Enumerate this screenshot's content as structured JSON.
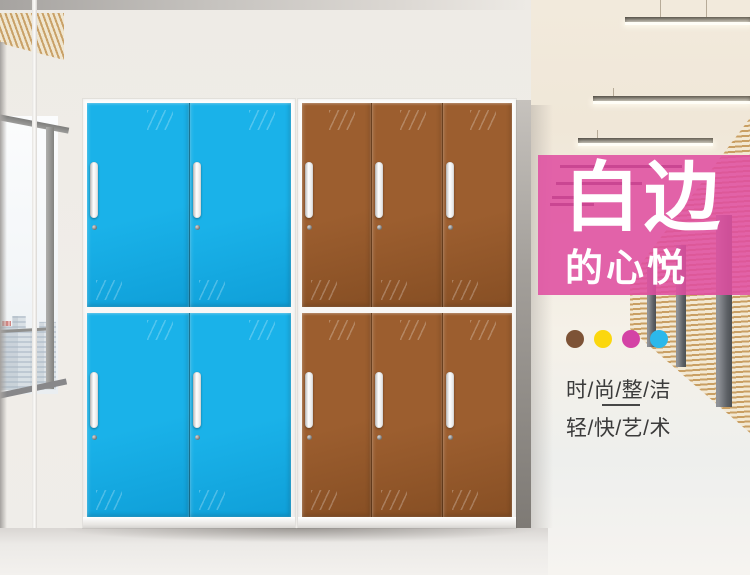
{
  "banner": {
    "title": "白边",
    "subtitle": "的心悦",
    "background_color": "#df4fa0",
    "text_color": "#ffffff"
  },
  "color_dots": [
    {
      "name": "brown",
      "color": "#7d5336"
    },
    {
      "name": "yellow",
      "color": "#fbd70e"
    },
    {
      "name": "magenta",
      "color": "#d443a5"
    },
    {
      "name": "cyan",
      "color": "#2cb8ea"
    }
  ],
  "slogans": {
    "line1": "时/尚/整/洁",
    "line2": "轻/快/艺/术"
  },
  "cabinets": [
    {
      "name": "blue-locker",
      "rows": 2,
      "cols": 2,
      "door_color": "#1ab2e9",
      "door_color_dark": "#0f9fd8"
    },
    {
      "name": "brown-locker",
      "rows": 2,
      "cols": 3,
      "door_color": "#9c5e2f",
      "door_color_dark": "#874f24"
    }
  ]
}
